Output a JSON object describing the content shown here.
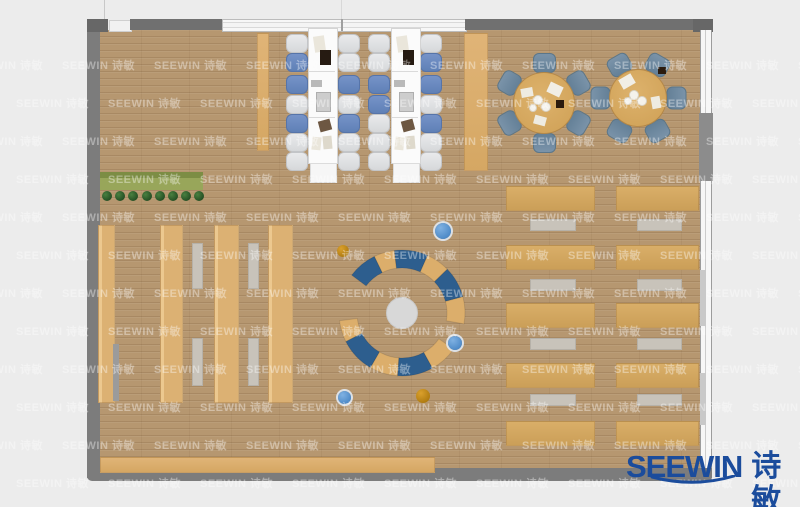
{
  "meta": {
    "type": "floor-plan-render"
  },
  "watermark": {
    "text": "SEEWIN 诗敏",
    "row0_y": 57,
    "row_step": 38,
    "rows": 12,
    "col0_x": -30,
    "col_step": 92,
    "cols": 10,
    "alt_offset": 46
  },
  "logo": {
    "brand": "SEEWIN",
    "cn": "诗敏",
    "color": "#1b4c9c"
  },
  "colors": {
    "bg": "#ececec",
    "floor": "#b69770",
    "wall": "#7c7c7c",
    "wall_dark": "#676767",
    "wall_mid": "#707070",
    "furniture_wood": "#dcae6b",
    "shelf_wood": "#dfb57a",
    "desk_wood": "#d2a65f",
    "table_white": "#fbfbfb",
    "chair_white": "#e2e3e5",
    "chair_blue": "#6b8ac1",
    "chair_slate": "#6f88a0",
    "bench_gray": "#c8c3ba",
    "arc_blue": "#2d5e8e",
    "hub_gray": "#d8d8d8",
    "planter_green": "#98a65a",
    "planter_dark": "#7c8d44",
    "plant_green": "#1e4a20",
    "dot_blue": "#4a8bd0",
    "dot_orange": "#c2840e",
    "logo_blue": "#1b4c9c"
  },
  "scene": {
    "frame_rects": [
      {
        "n": "left-wall",
        "x": 87,
        "y": 20,
        "w": 13,
        "h": 458,
        "bg": "$wall"
      },
      {
        "n": "bottom-wall",
        "x": 87,
        "y": 468,
        "w": 625,
        "h": 13,
        "bg": "$wall",
        "br": "0 0 0 5px"
      },
      {
        "n": "top-left-corner-wall",
        "x": 87,
        "y": 19,
        "w": 21,
        "h": 13,
        "bg": "$wall_dark"
      },
      {
        "n": "top-door-gap",
        "x": 109,
        "y": 20,
        "w": 21,
        "h": 10,
        "bg": "#f1f1f1",
        "bd": "1px solid #cfcfcf"
      },
      {
        "n": "top-wall-left",
        "x": 130,
        "y": 19,
        "w": 92,
        "h": 11,
        "bg": "$wall_mid"
      },
      {
        "n": "glass-wall-top",
        "x": 222,
        "y": 19,
        "w": 243,
        "h": 11,
        "bg": "linear-gradient(180deg,#f7f7f7 0 2px,#d9d9d9 2px 3px,#f4f4f4 3px 7px,#d9d9d9 7px 8px,#f7f7f7 8px 11px)",
        "bd": "1px solid #bcbcbc"
      },
      {
        "n": "glass-mullion",
        "x": 341,
        "y": 19,
        "w": 2,
        "h": 12,
        "bg": "#9f9f9f"
      },
      {
        "n": "top-wall-right",
        "x": 465,
        "y": 19,
        "w": 230,
        "h": 11,
        "bg": "$wall_mid"
      },
      {
        "n": "top-right-corner-wall",
        "x": 693,
        "y": 19,
        "w": 20,
        "h": 13,
        "bg": "$wall_dark"
      },
      {
        "n": "right-window-wall",
        "x": 700,
        "y": 30,
        "w": 12,
        "h": 438,
        "bg": "linear-gradient(90deg,#9c9c9c 0 1px,#f7f7f7 1px 5px,#cccccc 5px 6px,#f7f7f7 6px 11px,#9c9c9c 11px 12px)"
      },
      {
        "n": "right-wall-pillar",
        "x": 699,
        "y": 113,
        "w": 14,
        "h": 68,
        "bg": "#8c8c8c"
      },
      {
        "n": "right-window-sill-1",
        "x": 700,
        "y": 270,
        "w": 6,
        "h": 56,
        "bg": "#c9c9c9"
      },
      {
        "n": "right-window-sill-2",
        "x": 700,
        "y": 373,
        "w": 6,
        "h": 52,
        "bg": "#c9c9c9"
      },
      {
        "n": "top-ceiling-line-a",
        "x": 104,
        "y": 0,
        "w": 1,
        "h": 19,
        "bg": "#c8c8c8"
      },
      {
        "n": "top-ceiling-line-b",
        "x": 341,
        "y": 0,
        "w": 1,
        "h": 19,
        "bg": "#d8d8d8"
      }
    ],
    "planter": {
      "box": {
        "x": 100,
        "y": 172,
        "w": 103,
        "h": 18
      },
      "plant_y": 196,
      "plant_r": 5,
      "plant_x0": 107,
      "plant_dx": 13.2,
      "plant_count": 8
    },
    "shelves": {
      "y": 225,
      "h": 176,
      "strips": [
        {
          "x": 98,
          "w": 15
        },
        {
          "x": 160,
          "w": 21
        },
        {
          "x": 214,
          "w": 23
        },
        {
          "x": 268,
          "w": 23
        }
      ],
      "shadow": {
        "x": 113,
        "y": 344,
        "w": 6,
        "h": 57
      },
      "benches": [
        {
          "x": 192,
          "y": 243,
          "w": 9,
          "h": 44
        },
        {
          "x": 192,
          "y": 338,
          "w": 9,
          "h": 46
        },
        {
          "x": 248,
          "y": 243,
          "w": 9,
          "h": 44
        },
        {
          "x": 248,
          "y": 338,
          "w": 9,
          "h": 46
        }
      ]
    },
    "study_tables": {
      "tables_x": [
        308,
        391
      ],
      "y": 28,
      "w": 28,
      "h": 134,
      "divider_dys": [
        43,
        89
      ],
      "cap": {
        "dx": 2,
        "dy": 135,
        "w": 25,
        "h": 18
      },
      "side_strips": [
        {
          "x": 257,
          "y": 33,
          "w": 10,
          "h": 116
        },
        {
          "x": 464,
          "y": 33,
          "w": 22,
          "h": 136
        }
      ],
      "chair_w": 20,
      "chair_h": 17,
      "chair_ys": [
        34,
        53,
        75,
        95,
        114,
        133,
        152
      ],
      "chair_cols": [
        {
          "x": 286,
          "pattern": "WBBWBWW"
        },
        {
          "x": 338,
          "pattern": "WWBWBWW"
        },
        {
          "x": 368,
          "pattern": "WWBBWWW"
        },
        {
          "x": 420,
          "pattern": "WBBWBWW"
        }
      ],
      "items": [
        {
          "dx": 6,
          "dy": 8,
          "w": 11,
          "h": 16,
          "bg": "#eae6db",
          "rot": -8
        },
        {
          "dx": 12,
          "dy": 22,
          "w": 11,
          "h": 15,
          "bg": "#261b12"
        },
        {
          "dx": 3,
          "dy": 52,
          "w": 11,
          "h": 7,
          "bg": "#b9b9b9"
        },
        {
          "dx": 8,
          "dy": 64,
          "w": 13,
          "h": 18,
          "bg": "#cdcdcd",
          "bd": "1px solid #aeaeae"
        },
        {
          "dx": 11,
          "dy": 92,
          "w": 12,
          "h": 11,
          "bg": "#6d5742",
          "rot": -15
        },
        {
          "dx": 4,
          "dy": 109,
          "w": 9,
          "h": 13,
          "bg": "#eae6db",
          "rot": 6
        },
        {
          "dx": 15,
          "dy": 108,
          "w": 9,
          "h": 13,
          "bg": "#ded9cc",
          "rot": -5
        }
      ]
    },
    "round_tables": [
      {
        "n": "round-table-1",
        "cx": 543,
        "cy": 102,
        "r": 30,
        "chair_dist": 40,
        "chair_angles": [
          90,
          150,
          210,
          270,
          330,
          30
        ],
        "items": [
          {
            "dx": 5,
            "dy": -18,
            "w": 14,
            "h": 11,
            "bg": "#f1eee6",
            "rot": 25
          },
          {
            "dx": -22,
            "dy": -14,
            "w": 12,
            "h": 9,
            "bg": "#eeebe1",
            "rot": -10
          },
          {
            "dx": 13,
            "dy": -2,
            "w": 8,
            "h": 8,
            "bg": "#2b1b0e"
          },
          {
            "dx": -9,
            "dy": 14,
            "w": 12,
            "h": 9,
            "bg": "#eeebe1",
            "rot": 15
          }
        ],
        "plates": [
          {
            "dx": -6,
            "dy": -3,
            "r": 4
          },
          {
            "dx": 2,
            "dy": 4,
            "r": 4
          },
          {
            "dx": -11,
            "dy": 5,
            "r": 3
          }
        ]
      },
      {
        "n": "round-table-2",
        "cx": 637,
        "cy": 97,
        "r": 28,
        "chair_dist": 38,
        "chair_angles": [
          60,
          120,
          180,
          240,
          300,
          0
        ],
        "items": [
          {
            "dx": -17,
            "dy": -21,
            "w": 14,
            "h": 11,
            "bg": "#f1eee6",
            "rot": -30
          },
          {
            "dx": 21,
            "dy": -30,
            "w": 8,
            "h": 7,
            "bg": "#2b1b0e"
          },
          {
            "dx": 13,
            "dy": 1,
            "w": 12,
            "h": 9,
            "bg": "#eeebe1",
            "rot": 80
          }
        ],
        "plates": [
          {
            "dx": -4,
            "dy": -3,
            "r": 4
          },
          {
            "dx": 4,
            "dy": 3,
            "r": 4
          },
          {
            "dx": -10,
            "dy": 3,
            "r": 3
          }
        ]
      }
    ],
    "desk_area": {
      "cols": [
        {
          "x": 506,
          "w": 87,
          "bx": 530,
          "bw": 44
        },
        {
          "x": 616,
          "w": 81,
          "bx": 637,
          "bw": 43
        }
      ],
      "desk_ys": [
        186,
        245,
        303,
        363,
        421
      ],
      "desk_h": 23,
      "bench_ys": [
        219,
        279,
        338,
        394
      ],
      "bench_h": 10
    },
    "bottom_shelf": {
      "x": 100,
      "y": 457,
      "w": 333,
      "h": 14
    },
    "lounge": {
      "cx": 402,
      "cy": 313,
      "r_inner": 45,
      "r_outer": 63,
      "hub_r": 15.5,
      "upper": [
        [
          143,
          116,
          "blue"
        ],
        [
          116,
          97,
          "wood"
        ],
        [
          97,
          66,
          "blue"
        ],
        [
          66,
          44,
          "wood"
        ],
        [
          44,
          15,
          "blue"
        ],
        [
          15,
          -10,
          "wood"
        ]
      ],
      "lower": [
        [
          187,
          207,
          "wood"
        ],
        [
          207,
          240,
          "blue"
        ],
        [
          240,
          266,
          "wood"
        ],
        [
          266,
          299,
          "blue"
        ],
        [
          299,
          325,
          "wood"
        ]
      ]
    },
    "dots": [
      {
        "x": 343,
        "y": 251,
        "r": 6,
        "c": "orange"
      },
      {
        "x": 443,
        "y": 231,
        "r": 8,
        "c": "blue"
      },
      {
        "x": 455,
        "y": 343,
        "r": 7,
        "c": "blue"
      },
      {
        "x": 344,
        "y": 397,
        "r": 6.5,
        "c": "blue"
      },
      {
        "x": 423,
        "y": 396,
        "r": 7,
        "c": "orange"
      }
    ]
  }
}
